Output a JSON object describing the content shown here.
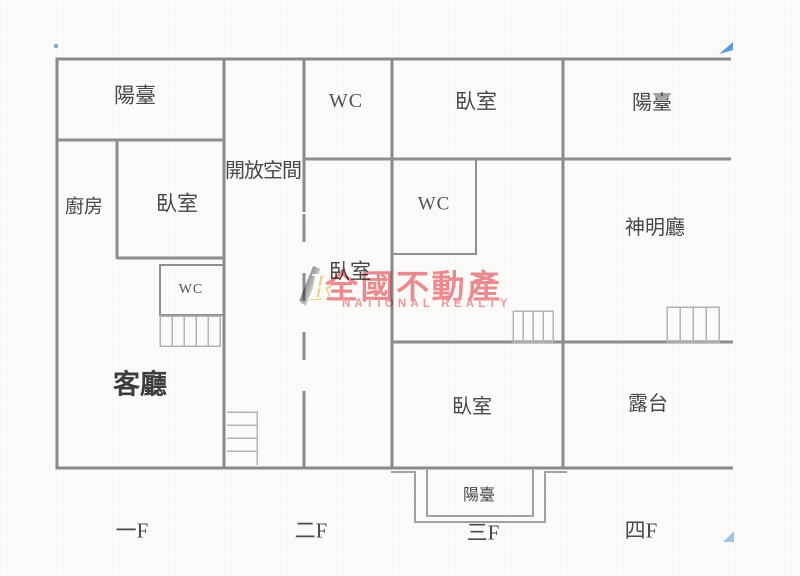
{
  "plan": {
    "rooms": {
      "balcony_1f": "陽臺",
      "kitchen": "廚房",
      "bedroom_1f": "臥室",
      "wc_1f": "WC",
      "living_room": "客廳",
      "open_space": "開放空間",
      "wc_2f": "WC",
      "bedroom_2f": "臥室",
      "bedroom_3f_top": "臥室",
      "wc_3f": "WC",
      "bedroom_3f": "臥室",
      "balcony_3f": "陽臺",
      "balcony_4f": "陽臺",
      "shrine_hall": "神明廳",
      "terrace": "露台"
    },
    "floor_labels": [
      "一F",
      "二F",
      "三F",
      "四F"
    ],
    "wall_color": "#8a8a8a",
    "stair_color": "#aeb5b7",
    "text_color": "#474747"
  },
  "watermark": {
    "logo_letter": "R",
    "title": "全國不動產",
    "subtitle": "NATIONAL REALTY",
    "pink": "#ec848c"
  },
  "artifacts": {
    "blue": "#5d9ed6"
  }
}
